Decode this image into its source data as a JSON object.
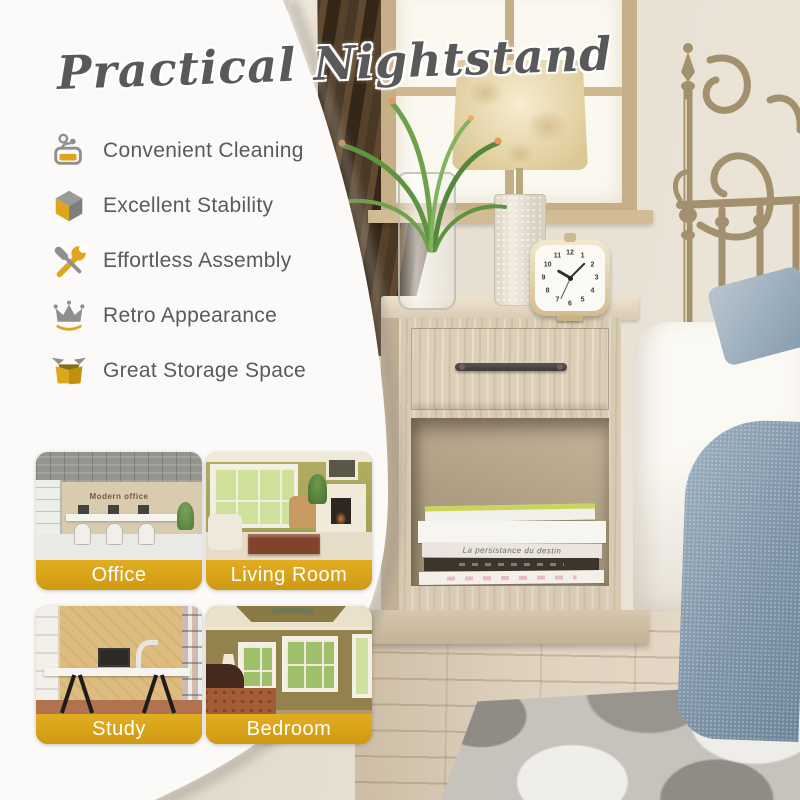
{
  "title": "Practical Nightstand",
  "features": [
    {
      "label": "Convenient Cleaning",
      "icon": "cleaning-icon"
    },
    {
      "label": "Excellent Stability",
      "icon": "cube-icon"
    },
    {
      "label": "Effortless Assembly",
      "icon": "tools-icon"
    },
    {
      "label": "Retro Appearance",
      "icon": "crown-icon"
    },
    {
      "label": "Great Storage Space",
      "icon": "open-box-icon"
    }
  ],
  "rooms": [
    {
      "label": "Office",
      "wall_text": "Modern office"
    },
    {
      "label": "Living Room"
    },
    {
      "label": "Study"
    },
    {
      "label": "Bedroom"
    }
  ],
  "photo": {
    "book_spine_text": "La persistance du destin",
    "clock_numerals": [
      "12",
      "1",
      "2",
      "3",
      "4",
      "5",
      "6",
      "7",
      "8",
      "9",
      "10",
      "11"
    ]
  },
  "colors": {
    "accent_gold": "#D9A41E",
    "icon_gray": "#8F8F8F",
    "text_gray": "#5A5A5A",
    "label_text": "#FFFFFF"
  }
}
